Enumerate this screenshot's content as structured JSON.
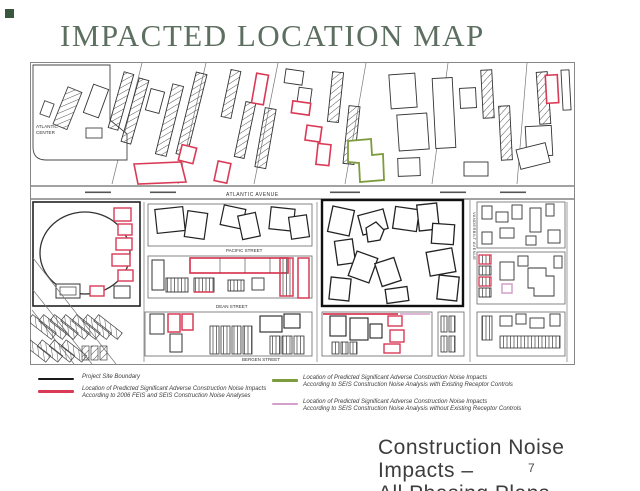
{
  "slide": {
    "title": "IMPACTED LOCATION MAP",
    "footer_line1": "Construction Noise Impacts –",
    "footer_line2": "All Phasing Plans",
    "page_number": "7"
  },
  "map": {
    "labels": {
      "atlantic_center_1": "ATLANTIC",
      "atlantic_center_2": "CENTER",
      "atlantic_avenue": "ATLANTIC AVENUE",
      "pacific_street": "PACIFIC STREET",
      "dean_street": "DEAN STREET",
      "bergen_street": "BERGEN STREET",
      "vanderbilt_avenue": "VANDERBILT AVENUE"
    }
  },
  "legend": {
    "items": [
      {
        "color_name": "black",
        "hex": "#1a1a1a",
        "lines": [
          "Project Site Boundary"
        ]
      },
      {
        "color_name": "red",
        "hex": "#d93a56",
        "lines": [
          "Location of Predicted Significant Adverse Construction Noise Impacts",
          "According to 2006 FEIS and SEIS Construction Noise Analyses"
        ]
      },
      {
        "color_name": "green",
        "hex": "#7d9c3d",
        "lines": [
          "Location of Predicted Significant Adverse Construction Noise Impacts",
          "According to SEIS Construction Noise Analysis with Existing Receptor Controls"
        ]
      },
      {
        "color_name": "pink",
        "hex": "#d49fca",
        "lines": [
          "Location of Predicted Significant Adverse Construction Noise Impacts",
          "According to SEIS Construction Noise Analysis without Existing Receptor Controls"
        ]
      }
    ]
  },
  "colors": {
    "title_text": "#5d6f60",
    "corner_square": "#39573f",
    "map_line": "#333333",
    "impact_red": "#d93a56",
    "impact_green": "#7d9c3d",
    "impact_pink": "#d49fca",
    "footer_text": "#3d3d3d"
  }
}
